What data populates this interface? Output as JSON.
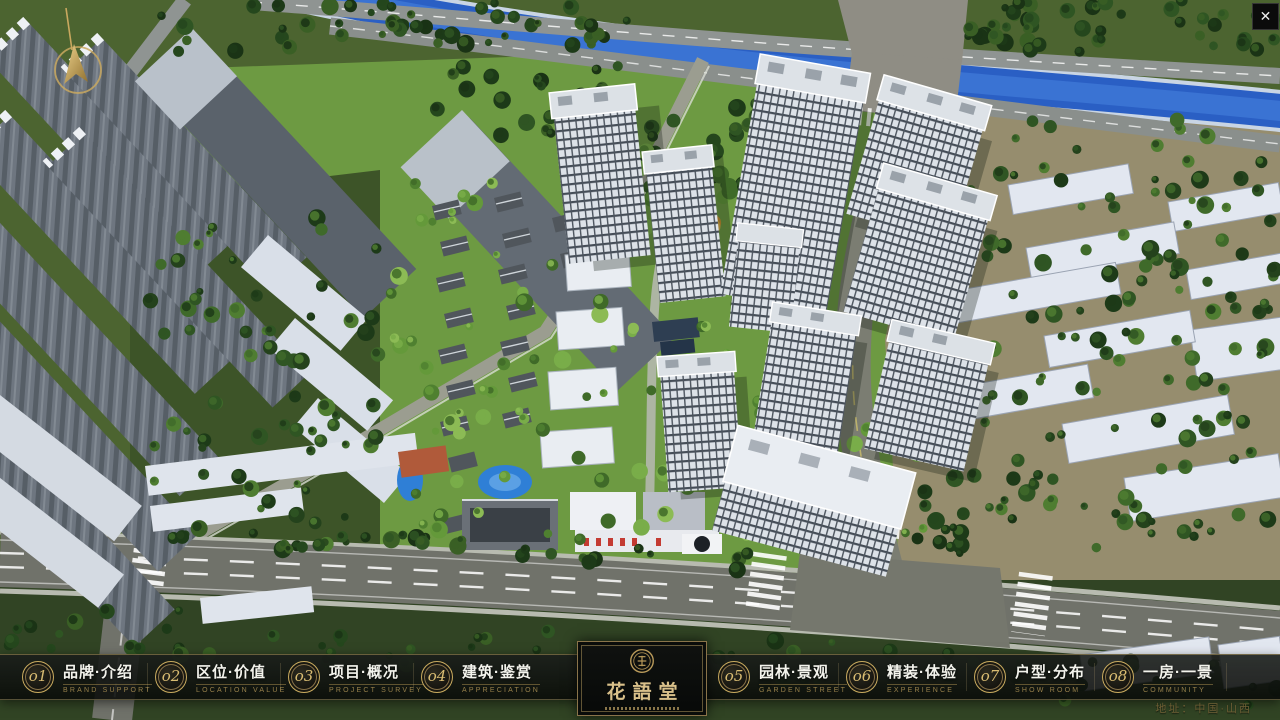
{
  "nav": {
    "items": [
      {
        "num": "o1",
        "title": "品牌·介绍",
        "subtitle": "BRAND SUPPORT"
      },
      {
        "num": "o2",
        "title": "区位·价值",
        "subtitle": "LOCATION VALUE"
      },
      {
        "num": "o3",
        "title": "项目·概况",
        "subtitle": "PROJECT SURVEY"
      },
      {
        "num": "o4",
        "title": "建筑·鉴赏",
        "subtitle": "APPRECIATION"
      },
      {
        "num": "o5",
        "title": "园林·景观",
        "subtitle": "GARDEN STREET"
      },
      {
        "num": "o6",
        "title": "精装·体验",
        "subtitle": "EXPERIENCE"
      },
      {
        "num": "o7",
        "title": "户型·分布",
        "subtitle": "SHOW ROOM"
      },
      {
        "num": "o8",
        "title": "一房·一景",
        "subtitle": "COMMUNITY"
      }
    ]
  },
  "logo": {
    "name": "花語堂"
  },
  "footer": {
    "address": "地址：中国·山西"
  },
  "icons": {
    "close": "✕",
    "compass": "north-arrow",
    "seal": "brand-seal"
  },
  "colors": {
    "accent_gold": "#c9ab5f",
    "bar_bg": "#0d0f0c",
    "label_white": "#f3f3ec",
    "subtitle_gold": "#97804b"
  }
}
